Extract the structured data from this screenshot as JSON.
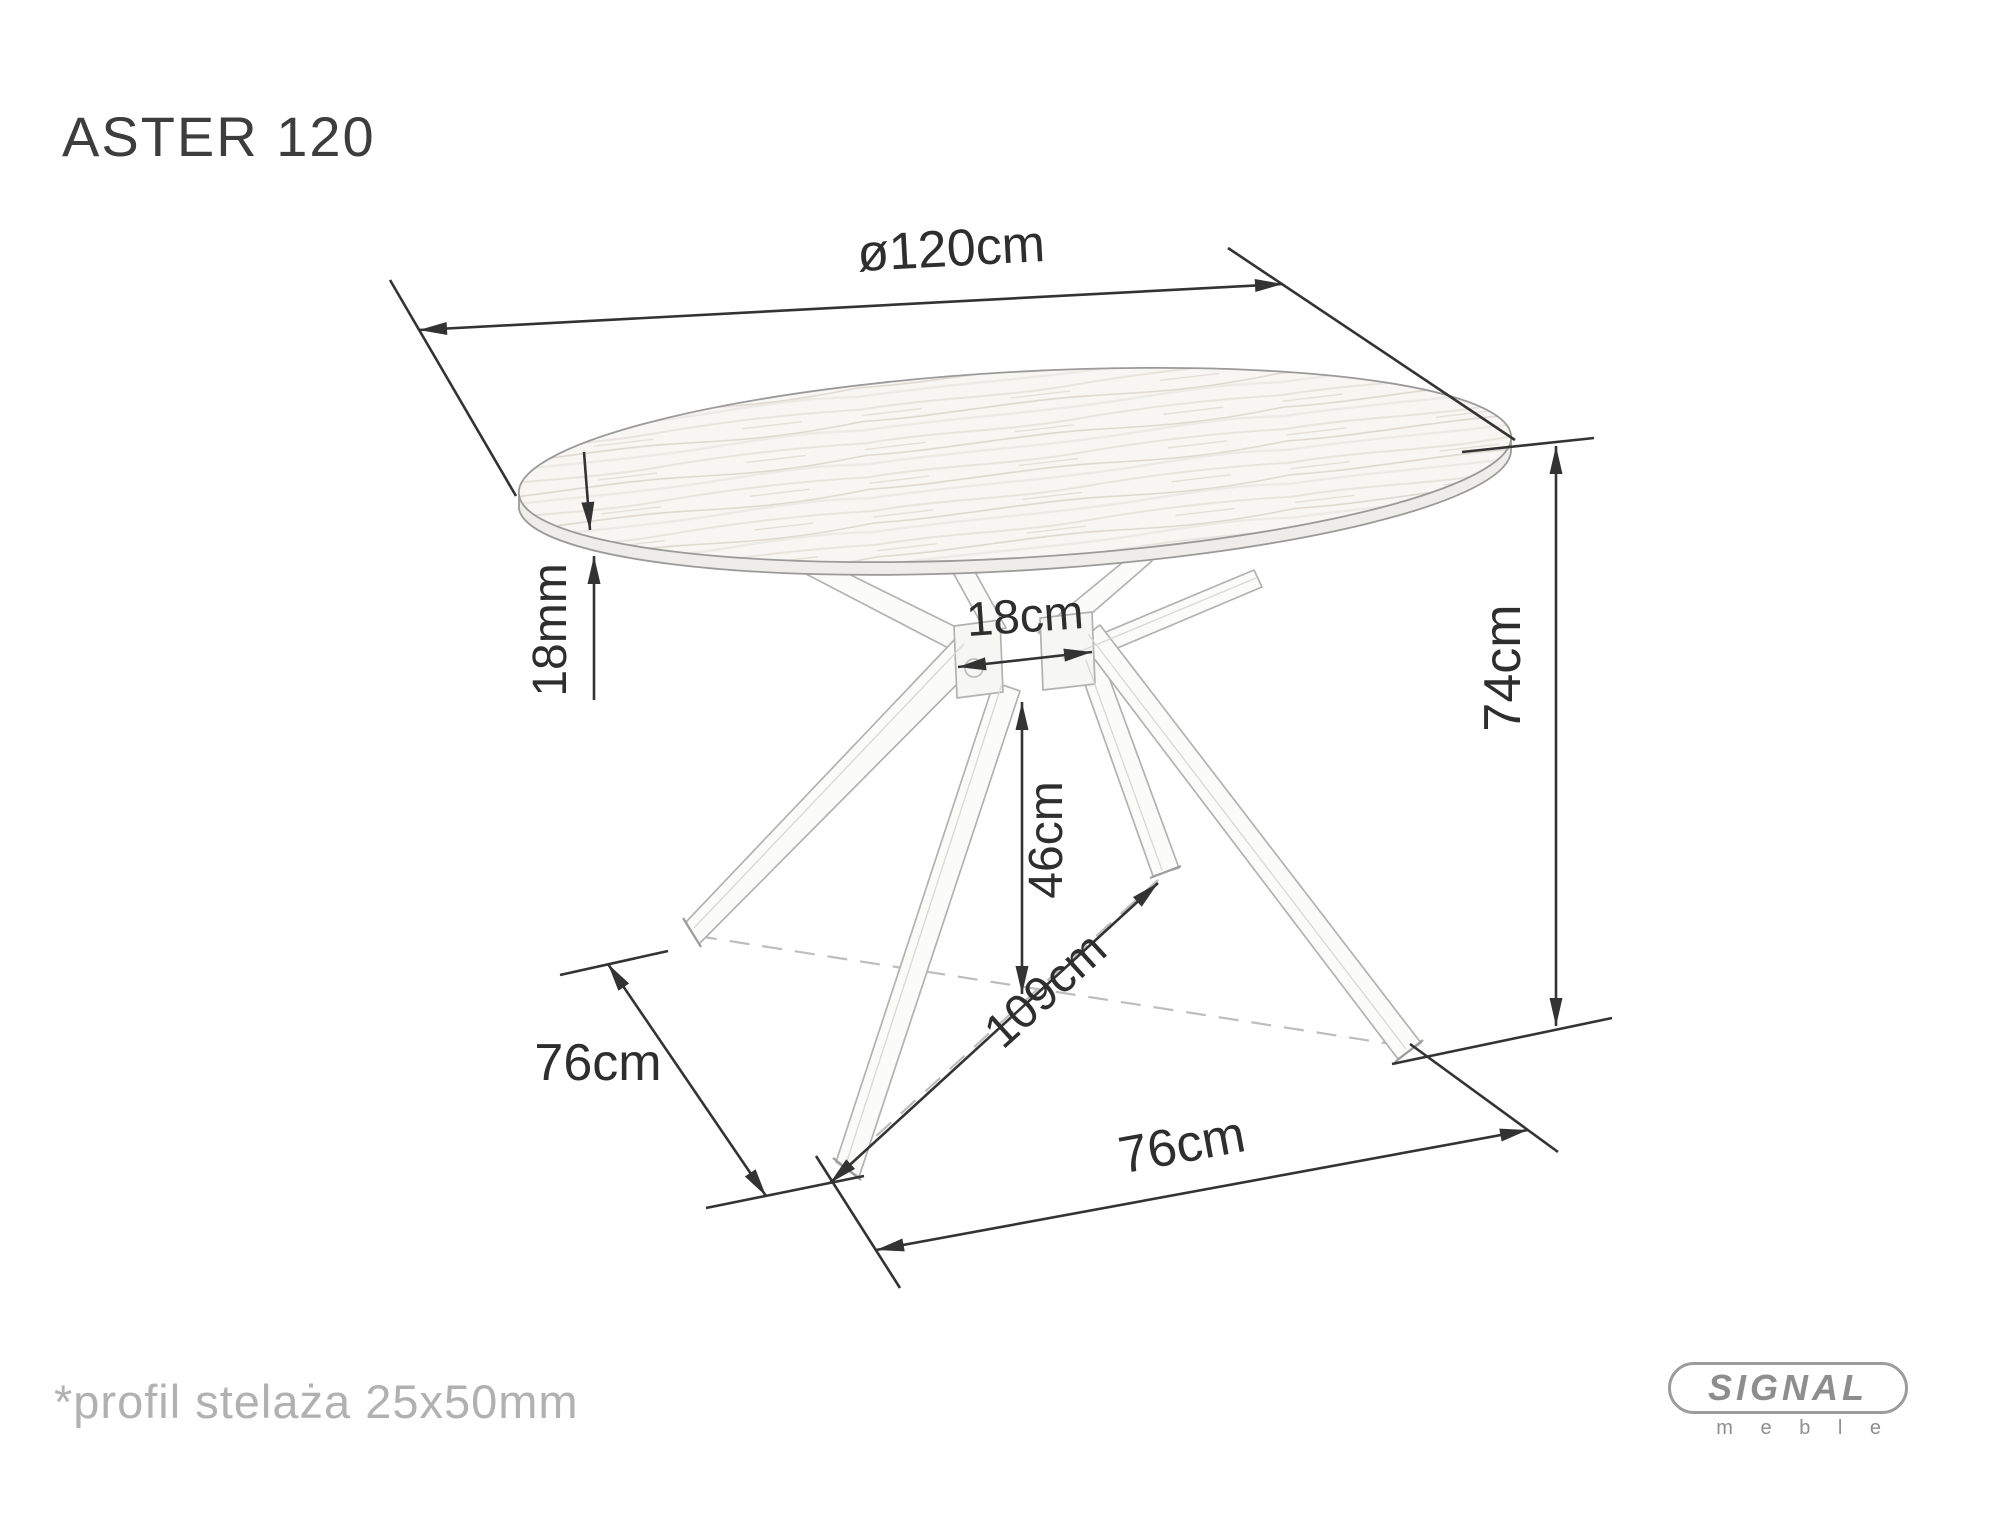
{
  "title": "ASTER 120",
  "dims": {
    "diameter": "ø120cm",
    "top_thickness": "18mm",
    "hub_width": "18cm",
    "hub_floor_clearance": "46cm",
    "feet_diagonal": "109cm",
    "table_height": "74cm",
    "base_left_spacing": "76cm",
    "base_front_spacing": "76cm"
  },
  "footnote": "*profil stelaża 25x50mm",
  "logo": {
    "brand": "SIGNAL",
    "sub": "m e b l e"
  },
  "colors": {
    "dimension_lines": "#333333",
    "drawing_outline": "#9a9a9a",
    "dashed_projection": "#bdbdbd",
    "muted_text": "#b1b1b1",
    "logo_gray": "#8e8e8e"
  }
}
